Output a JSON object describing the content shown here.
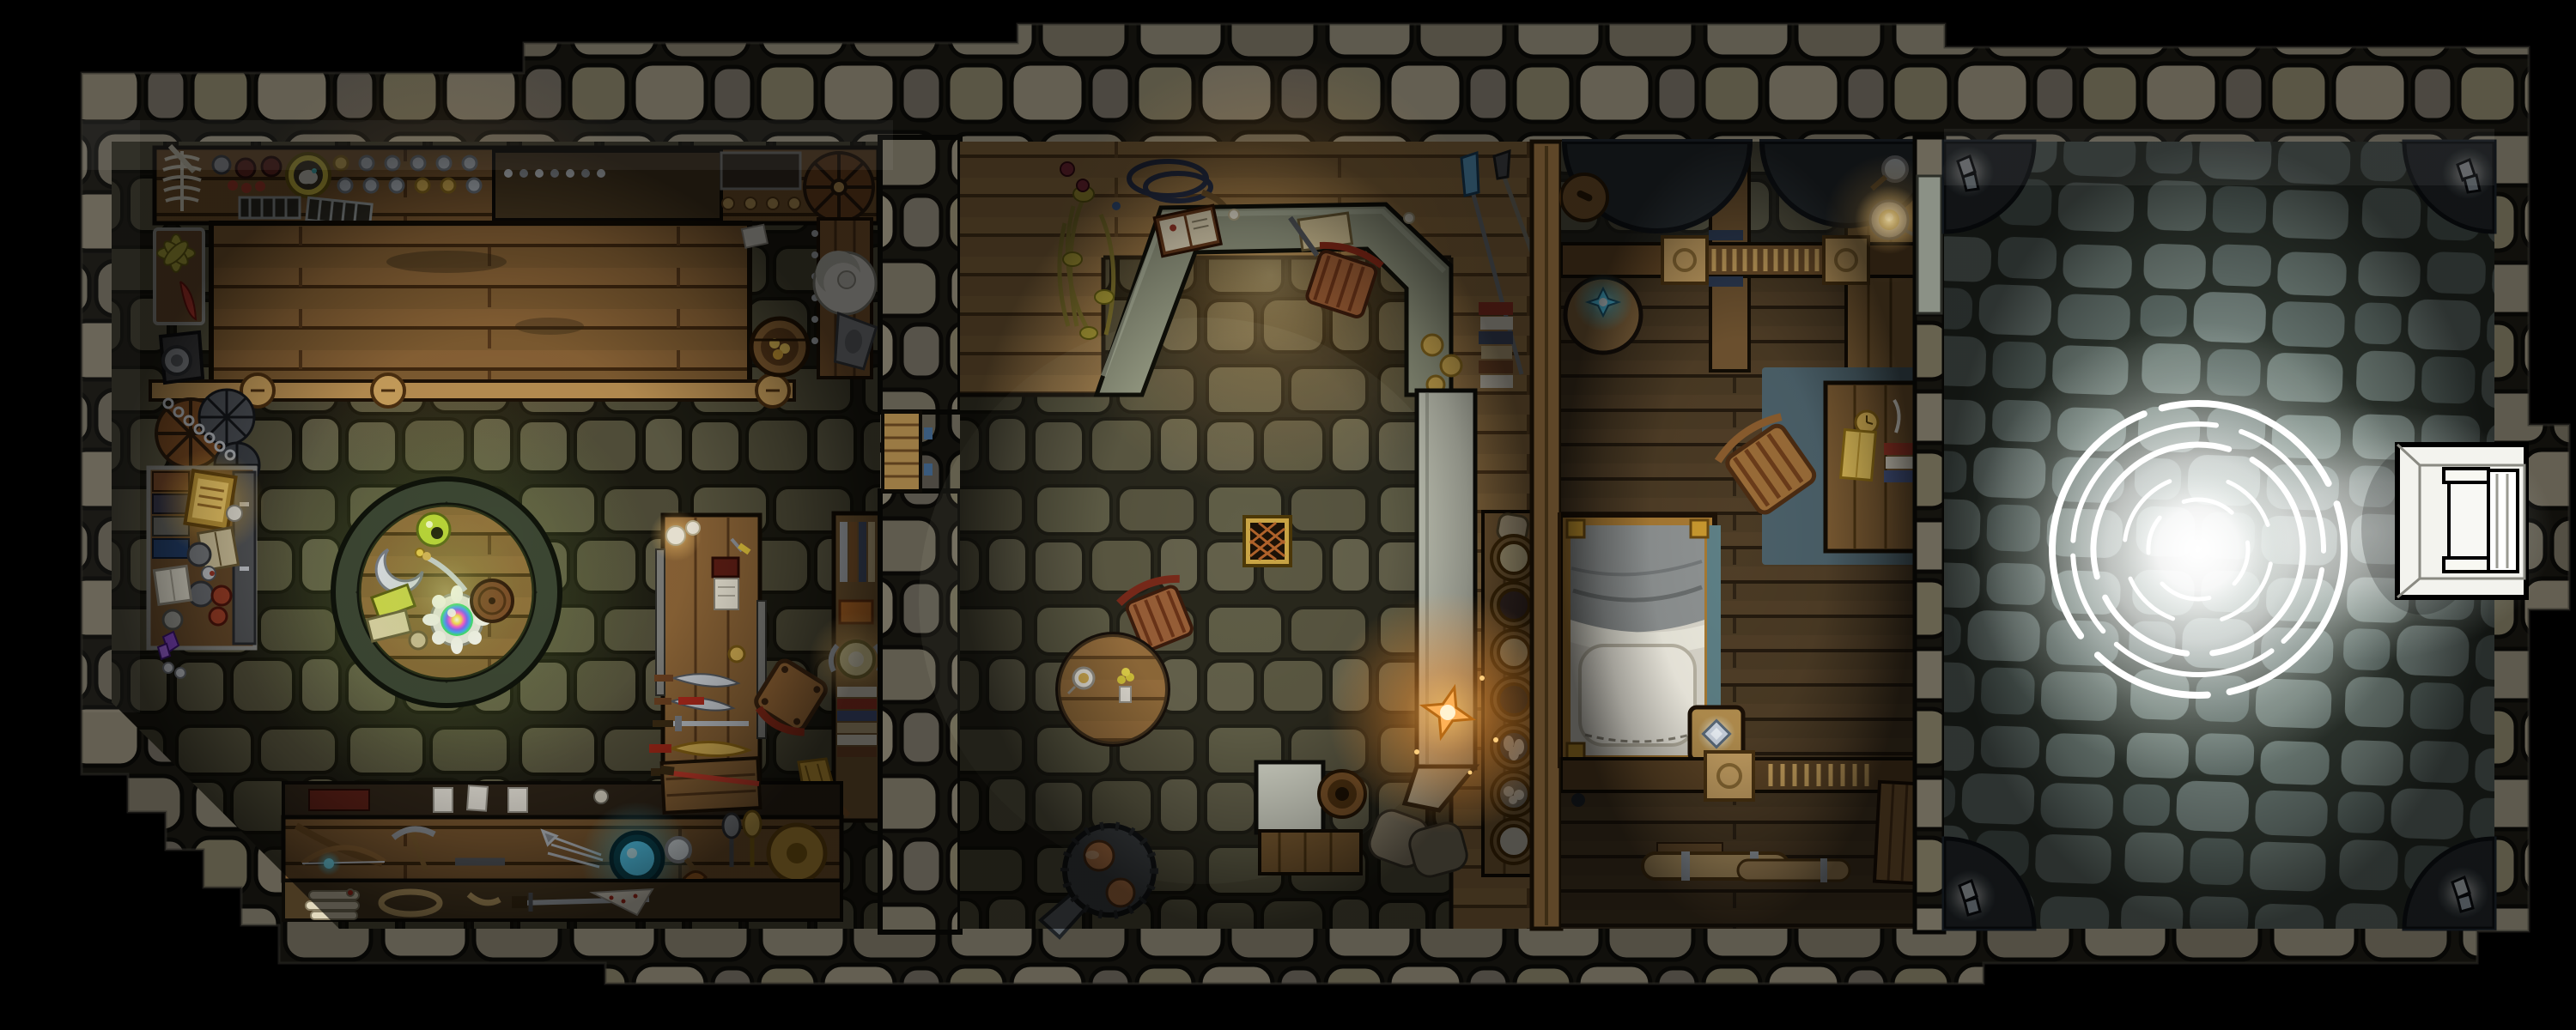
{
  "map": {
    "label": "Top-down fantasy battle map of a stone building with shop, common room, living quarters and a glowing courtyard",
    "areas": [
      {
        "id": "shop",
        "label": "Shop workshop with display shelf, long counter, arcane round table, weapon rack and workbench"
      },
      {
        "id": "common-room",
        "label": "Common room with reception counter, round dining table, pot-bellied stove, lantern and pantry shelf"
      },
      {
        "id": "quarters",
        "label": "Living quarters with basins, railing, bed, bedside stool, desk and storage"
      },
      {
        "id": "courtyard",
        "label": "Stone courtyard with radiant summoning circle, corner crystals and white portal seat"
      }
    ],
    "palette": {
      "background": "#000000",
      "wall_stone": "#6b675a",
      "floor_stone": "#55523d",
      "courtyard_stone": "#717e77",
      "wood_light": "#a5804c",
      "wood_dark": "#503e27",
      "magic_glow": "#ffffff",
      "lantern_flame": "#ffb257",
      "candle_glow": "#ffcf7d",
      "arcane_green": "#c9e464",
      "gem_cyan": "#59d8ff",
      "crystal_white": "#eef6fc",
      "gold": "#d8b254",
      "blood_red": "#c43b2a"
    },
    "shop_objects": [
      "skeleton remains",
      "plate and coin shelf",
      "sleeping cat in round basket",
      "hanging drying racks",
      "long counter table",
      "supply crate with pinwheel and red feather",
      "gear machine",
      "wagon wheels with chains",
      "curio case with illuminated manuscript, books, ore plates and purple crystal",
      "round arcane table with green orb, crescent charm, dagger, prism gem, books and drum",
      "weapon display table with five blades",
      "tipped chair",
      "bookshelf with glowing horned helm",
      "broom",
      "workbench with crossbow, pickaxe, glowing blue bowl, magnifying glass, axe, maces and shield",
      "scrolls, rope coil, long sword and saw",
      "leaning door with red sword",
      "open coin barrel",
      "white hat on plank",
      "bellows"
    ],
    "common_room_objects": [
      "dried flowers",
      "coiled dark rope",
      "angled reception counter",
      "open ledger",
      "scroll",
      "counter chair",
      "candles",
      "floor grate",
      "round dining table with teacup and flowers",
      "dining chair",
      "pot-bellied stove with pipe",
      "glowing lantern",
      "white service counter",
      "storage barrel",
      "grain sacks",
      "pantry shelf with seven bowls",
      "stacked colorful books",
      "gold plates",
      "blue crystal spear",
      "iron staff"
    ],
    "quarters_objects": [
      "two dark basins",
      "hanging wooden disc",
      "wall shelf with magnifying glass and lit candle dish",
      "railing with ladder gate",
      "side table with glowing compass gem",
      "bed with grey blanket and white pillow",
      "bedside stool with diamond gem",
      "slate rug",
      "desk with clock, yellow book, quill and book stack",
      "desk chair",
      "storage rail",
      "fabric bolts with metal bands",
      "leaning plank door"
    ],
    "courtyard_objects": [
      "irregular flagstone paving",
      "four corner crystal clusters",
      "three-ring summoning circle",
      "radiant white glow",
      "white portal dais with seat"
    ],
    "counts": {
      "weapon_rack_blades": 5,
      "pantry_bowls": 7,
      "magic_circle_rings": 3,
      "corner_crystal_clusters": 4
    }
  }
}
